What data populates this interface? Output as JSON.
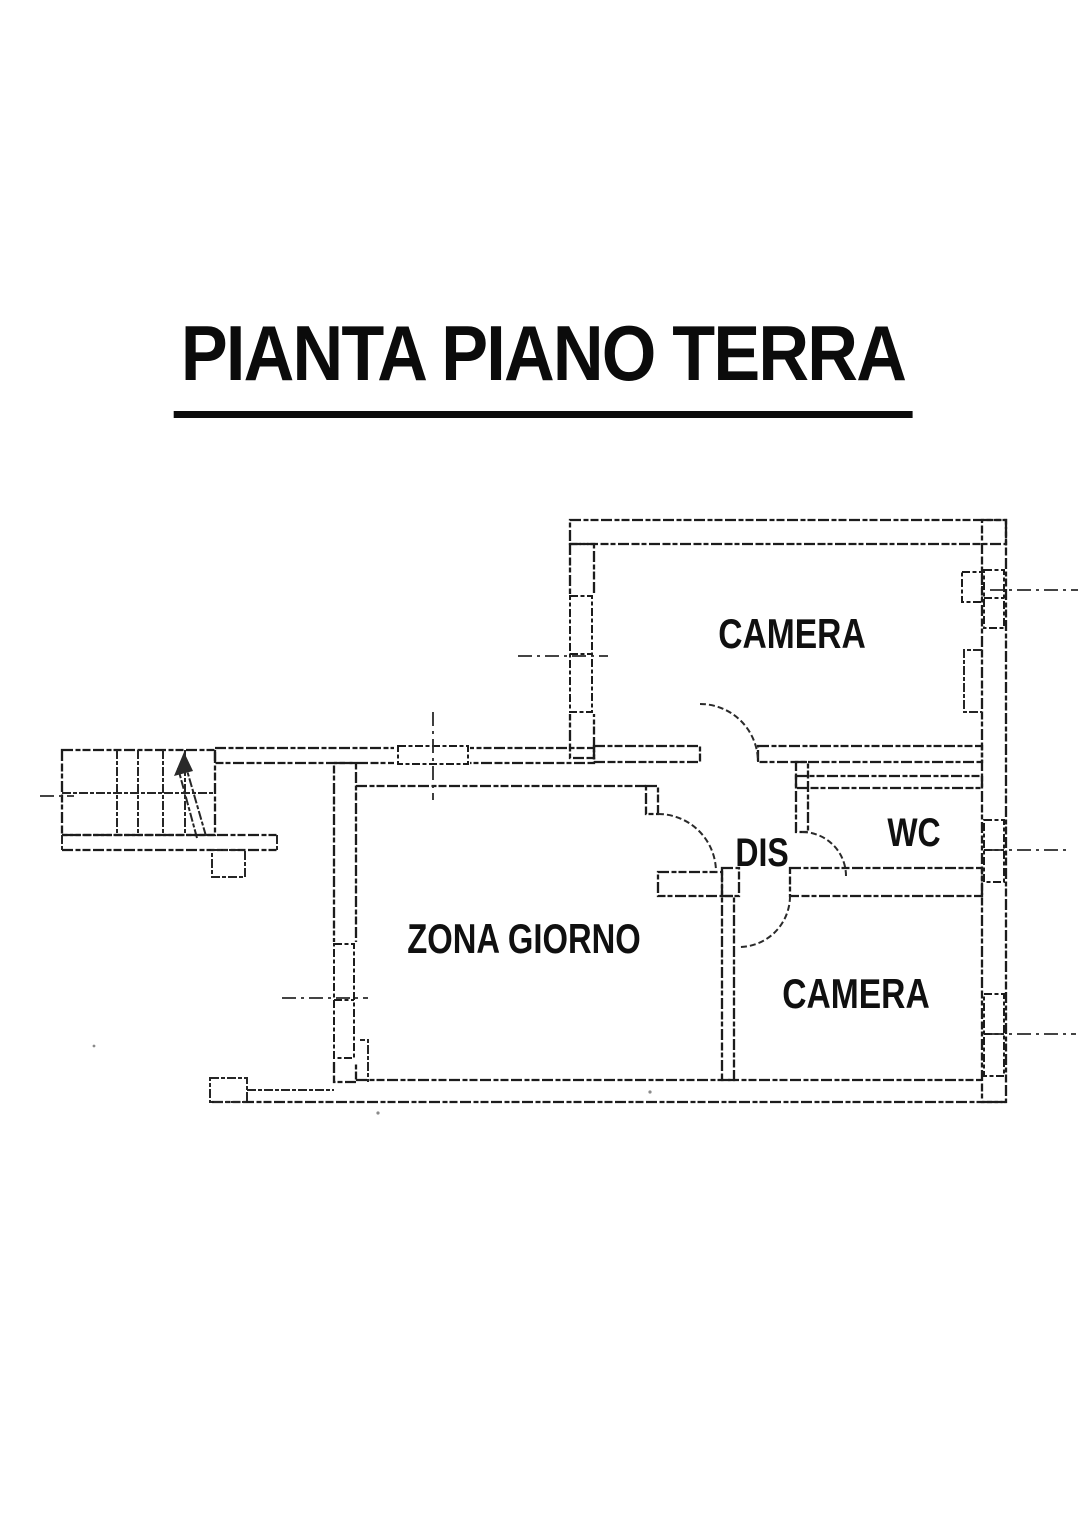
{
  "document": {
    "title": "PIANTA PIANO TERRA"
  },
  "floor_plan": {
    "rooms": [
      {
        "id": "camera-nord",
        "label": "CAMERA"
      },
      {
        "id": "wc",
        "label": "WC"
      },
      {
        "id": "disimpegno",
        "label": "DIS"
      },
      {
        "id": "zona-giorno",
        "label": "ZONA GIORNO"
      },
      {
        "id": "camera-sud",
        "label": "CAMERA"
      }
    ]
  },
  "colors": {
    "ink": "#1c1c1c",
    "paper": "#ffffff"
  }
}
